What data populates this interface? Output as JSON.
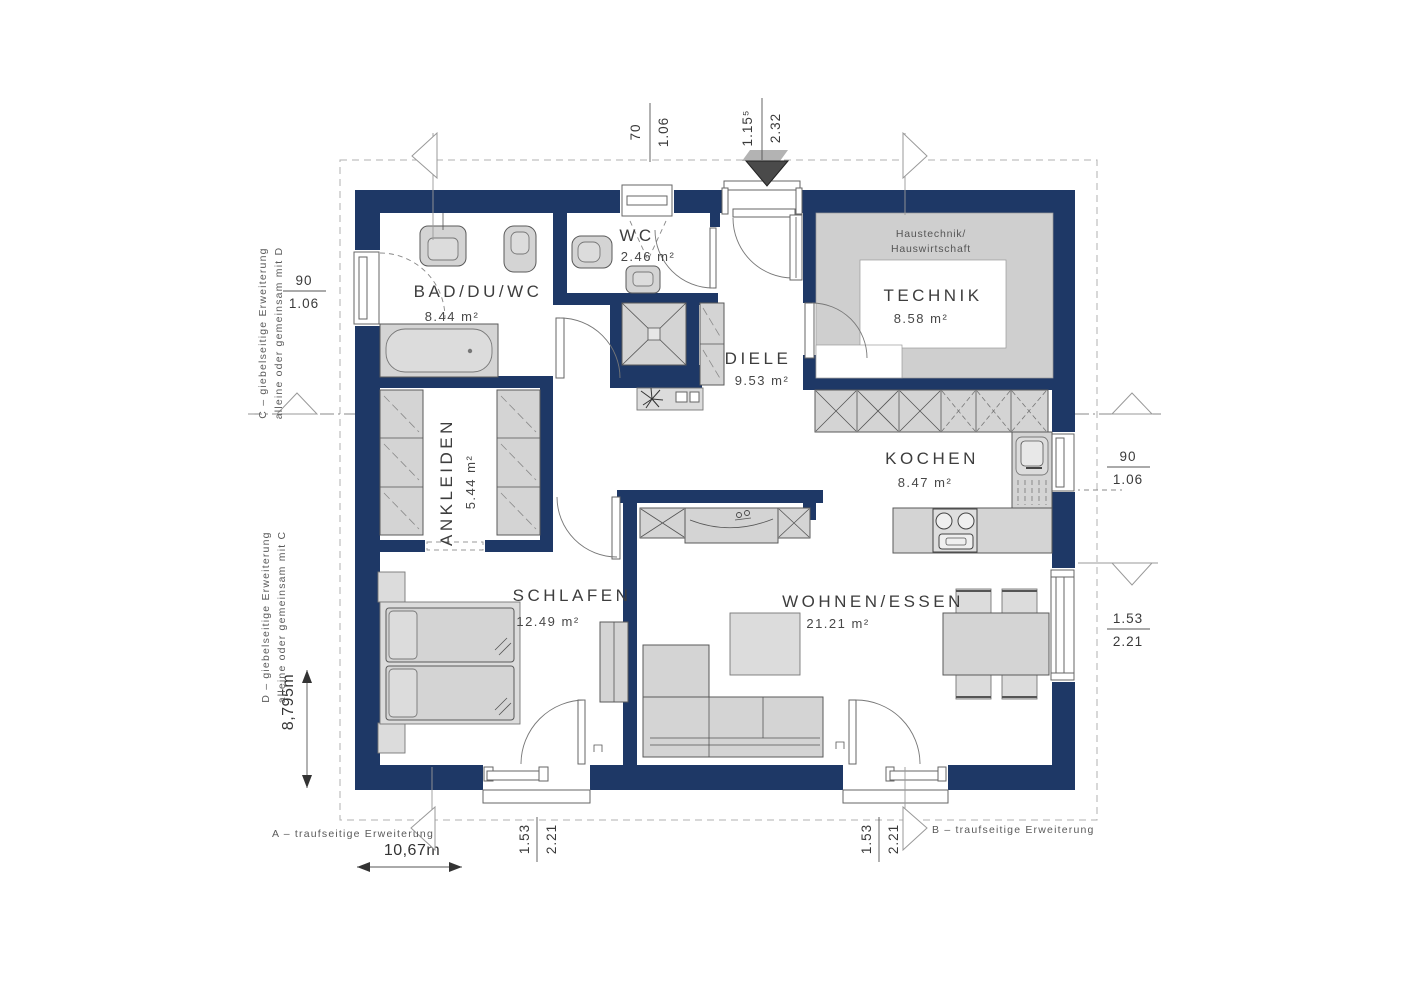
{
  "rooms": {
    "bad": {
      "name": "BAD/DU/WC",
      "area": "8.44 m²"
    },
    "wc": {
      "name": "WC",
      "area": "2.46 m²"
    },
    "diele": {
      "name": "DIELE",
      "area": "9.53 m²"
    },
    "technik": {
      "name": "TECHNIK",
      "area": "8.58 m²",
      "note1": "Haustechnik/",
      "note2": "Hauswirtschaft"
    },
    "ankleiden": {
      "name": "ANKLEIDEN",
      "area": "5.44 m²"
    },
    "kochen": {
      "name": "KOCHEN",
      "area": "8.47 m²"
    },
    "schlafen": {
      "name": "SCHLAFEN",
      "area": "12.49 m²"
    },
    "wohnen": {
      "name": "WOHNEN/ESSEN",
      "area": "21.21 m²"
    }
  },
  "dims": {
    "top_window": {
      "top": "70",
      "bottom": "1.06"
    },
    "entrance": {
      "top": "1.15⁵",
      "bottom": "2.32"
    },
    "left_window": {
      "top": "90",
      "bottom": "1.06"
    },
    "right_window": {
      "top": "90",
      "bottom": "1.06"
    },
    "right_door": {
      "top": "1.53",
      "bottom": "2.21"
    },
    "schlafen_door": {
      "top": "1.53",
      "bottom": "2.21"
    },
    "wohnen_door": {
      "top": "1.53",
      "bottom": "2.21"
    },
    "total_width": "10,67m",
    "total_height": "8,795m"
  },
  "margins": {
    "a": "A – traufseitige Erweiterung",
    "b": "B – traufseitige Erweiterung",
    "c1": "C – giebelseitige Erweiterung",
    "c2": "alleine oder gemeinsam mit D",
    "d1": "D – giebelseitige Erweiterung",
    "d2": "alleine oder gemeinsam mit C"
  },
  "colors": {
    "wall": "#1e3866",
    "furniture": "#d4d4d4",
    "floor_gray": "#cfcfcf",
    "line": "#555555"
  }
}
